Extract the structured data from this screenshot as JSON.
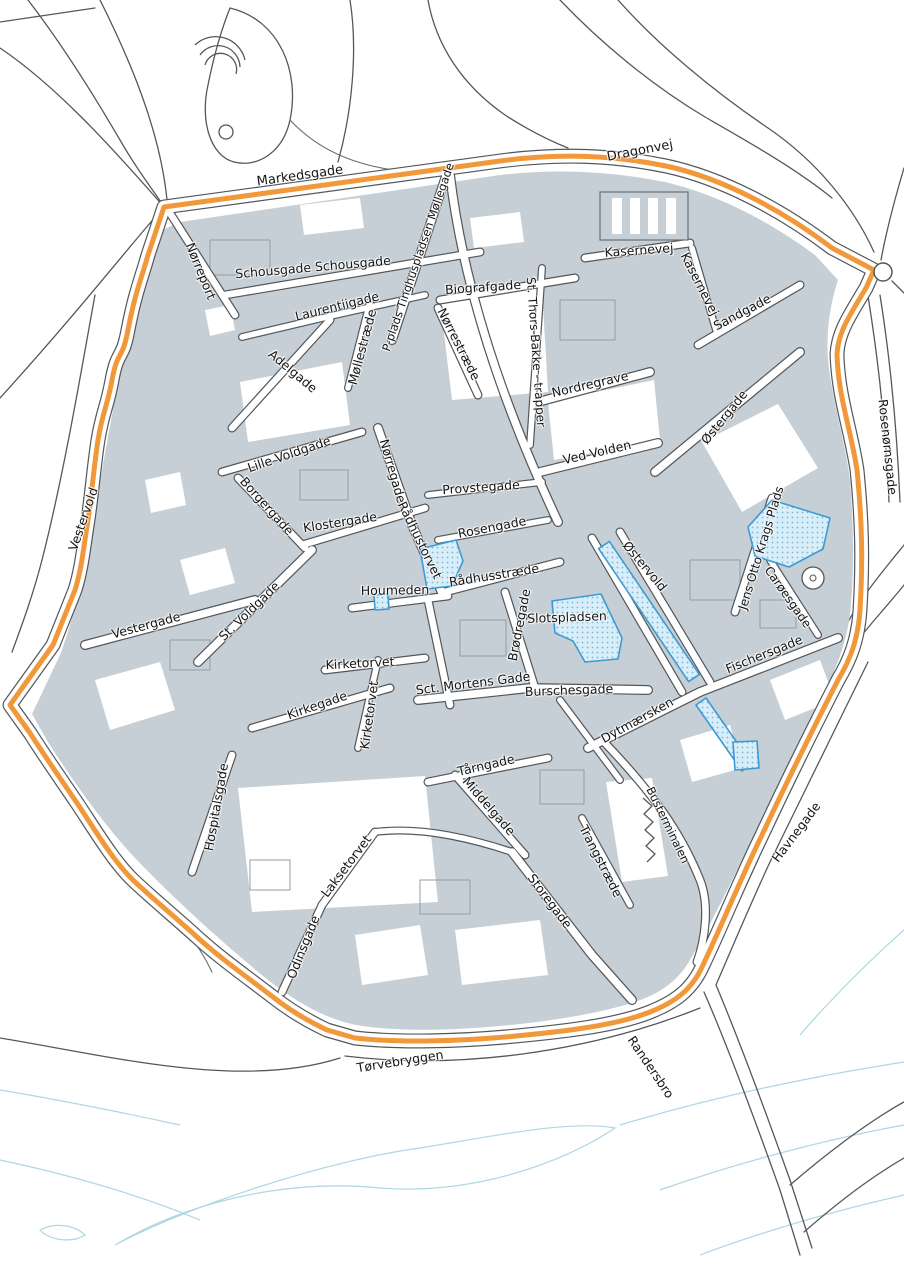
{
  "map": {
    "colors": {
      "boundary_orange": "#f0983a",
      "building_gray": "#c6cfd5",
      "road_casing": "#53565a",
      "highlight_fill": "#d8eef9",
      "highlight_border": "#3f9ad2",
      "water_blue": "#aed6e4",
      "label_color": "#151515"
    },
    "boundary_path": "M164,207 L500,161 C560,153 612,155 666,166 C722,178 782,210 832,248 L874,270 L866,288 C850,315 838,332 837,354 C838,396 851,430 857,470 C862,520 863,560 860,610 C858,640 850,660 838,680 C815,725 790,775 762,835 C740,880 722,925 703,965 C692,990 675,1002 650,1012 C615,1026 560,1032 505,1037 C460,1041 400,1043 355,1038 L327,1030 C310,1022 292,1012 273,997 C247,977 220,958 197,937 C175,917 153,899 133,880 C114,862 95,830 77,803 C60,778 42,752 30,733 L10,705 L53,645 L75,590 C82,568 84,544 88,520 C92,492 94,466 98,440 C103,410 107,408 112,380 C118,348 122,362 128,330 C135,293 141,280 148,255 Z",
    "areas": [
      {
        "name": "raadhustorvet-plaza",
        "path": "M420,549 L456,540 L463,561 L452,586 L427,589 Z"
      },
      {
        "name": "houmeden-plaza",
        "path": "M374,595 L388,594 L389,609 L375,610 Z"
      },
      {
        "name": "oestervold-promenade",
        "path": "M598.6,548.6 L609.4,541.4 L699.4,674.4 L688.6,681.6 Z"
      },
      {
        "name": "slotspladsen-plaza",
        "path": "M552,601 L601,594 L622,638 L618,659 L585,662 L573,641 L555,633 Z"
      },
      {
        "name": "dytmaersken-strip",
        "path": "M696,705 L706,698 L752,764 L742,771 Z"
      },
      {
        "name": "jens-otto-krags-plads-plaza",
        "path": "M755,556 L748,527 L772,500 L830,518 L823,549 L789,567 Z"
      },
      {
        "name": "havnegade-plaza",
        "path": "M733,742 L757,741 L759,768 L735,770 Z"
      }
    ],
    "labels": [
      {
        "text": "Markedsgade",
        "x": 300,
        "y": 176,
        "rot": -8,
        "size": 13
      },
      {
        "text": "Dragonvej",
        "x": 640,
        "y": 151,
        "rot": -11,
        "size": 13
      },
      {
        "text": "Nørreport",
        "x": 201,
        "y": 271,
        "rot": 68,
        "size": 12.5
      },
      {
        "text": "Schousgade Schousgade",
        "x": 313,
        "y": 267,
        "rot": -5,
        "size": 12.5
      },
      {
        "text": "Laurentiigade",
        "x": 337,
        "y": 306,
        "rot": -14,
        "size": 12.5
      },
      {
        "text": "P-plads Tinghuspladsen Møllegade",
        "x": 418,
        "y": 257,
        "rot": -71,
        "size": 11.5
      },
      {
        "text": "Møllestræde",
        "x": 362,
        "y": 347,
        "rot": -75,
        "size": 12.5
      },
      {
        "text": "Biografgade",
        "x": 483,
        "y": 287,
        "rot": -4,
        "size": 12.5
      },
      {
        "text": "Nørrestræde",
        "x": 459,
        "y": 344,
        "rot": 63,
        "size": 12.5
      },
      {
        "text": "St. Thors-Bakke - trapper",
        "x": 536,
        "y": 352,
        "rot": 86,
        "size": 12
      },
      {
        "text": "Kasernevej",
        "x": 639,
        "y": 250,
        "rot": -4,
        "size": 12.5
      },
      {
        "text": "Kasernevej",
        "x": 700,
        "y": 284,
        "rot": 63,
        "size": 12.5
      },
      {
        "text": "Sandgade",
        "x": 742,
        "y": 312,
        "rot": -28,
        "size": 12.5
      },
      {
        "text": "Nordregrave",
        "x": 590,
        "y": 384,
        "rot": -13,
        "size": 12.5
      },
      {
        "text": "Østergade",
        "x": 724,
        "y": 417,
        "rot": -51,
        "size": 12.5
      },
      {
        "text": "Rosenørnsgade",
        "x": 888,
        "y": 447,
        "rot": 84,
        "size": 12.5
      },
      {
        "text": "Ved Volden",
        "x": 597,
        "y": 452,
        "rot": -13,
        "size": 12.5
      },
      {
        "text": "Adelgade",
        "x": 293,
        "y": 371,
        "rot": 40,
        "size": 12.5
      },
      {
        "text": "Lille Voldgade",
        "x": 289,
        "y": 454,
        "rot": -19,
        "size": 12.5
      },
      {
        "text": "Borgergade",
        "x": 267,
        "y": 506,
        "rot": 48,
        "size": 12.5
      },
      {
        "text": "Klostergade",
        "x": 340,
        "y": 522,
        "rot": -9,
        "size": 12.5
      },
      {
        "text": "Nørregade",
        "x": 393,
        "y": 471,
        "rot": 74,
        "size": 12.5
      },
      {
        "text": "Rådhustorvet",
        "x": 420,
        "y": 540,
        "rot": 64,
        "size": 12.5
      },
      {
        "text": "Provstegade",
        "x": 481,
        "y": 487,
        "rot": -4,
        "size": 12.5
      },
      {
        "text": "Rosengade",
        "x": 492,
        "y": 527,
        "rot": -11,
        "size": 12.5
      },
      {
        "text": "Rådhusstræde",
        "x": 494,
        "y": 575,
        "rot": -9,
        "size": 12.5
      },
      {
        "text": "Houmeden",
        "x": 395,
        "y": 590,
        "rot": -1,
        "size": 12.5
      },
      {
        "text": "Brødregade",
        "x": 519,
        "y": 625,
        "rot": -79,
        "size": 12.5
      },
      {
        "text": "Slotspladsen",
        "x": 567,
        "y": 617,
        "rot": -2,
        "size": 12.5
      },
      {
        "text": "Østervold",
        "x": 645,
        "y": 566,
        "rot": 50,
        "size": 12.5
      },
      {
        "text": "Jens Otto Krags Plads",
        "x": 761,
        "y": 548,
        "rot": -73,
        "size": 12
      },
      {
        "text": "Carøesgade",
        "x": 788,
        "y": 597,
        "rot": 55,
        "size": 12
      },
      {
        "text": "Fischersgade",
        "x": 764,
        "y": 654,
        "rot": -22,
        "size": 12.5
      },
      {
        "text": "Vestervold",
        "x": 83,
        "y": 519,
        "rot": -71,
        "size": 12.5
      },
      {
        "text": "Vestergade",
        "x": 146,
        "y": 625,
        "rot": -15,
        "size": 12.5
      },
      {
        "text": "St. Voldgade",
        "x": 249,
        "y": 611,
        "rot": -44,
        "size": 12.5
      },
      {
        "text": "Kirketorvet",
        "x": 360,
        "y": 663,
        "rot": -3,
        "size": 12.5
      },
      {
        "text": "Kirkegade",
        "x": 317,
        "y": 705,
        "rot": -19,
        "size": 12.5
      },
      {
        "text": "Kirketorvet",
        "x": 369,
        "y": 715,
        "rot": -82,
        "size": 12.5
      },
      {
        "text": "Sct. Mortens Gade",
        "x": 473,
        "y": 683,
        "rot": -7,
        "size": 12.5
      },
      {
        "text": "Burschesgade",
        "x": 569,
        "y": 690,
        "rot": -2,
        "size": 12.5
      },
      {
        "text": "Dytmærsken",
        "x": 637,
        "y": 720,
        "rot": -29,
        "size": 12.5
      },
      {
        "text": "Tårngade",
        "x": 486,
        "y": 765,
        "rot": -13,
        "size": 12.5
      },
      {
        "text": "Middelgade",
        "x": 489,
        "y": 806,
        "rot": 49,
        "size": 12.5
      },
      {
        "text": "Trangstræde",
        "x": 601,
        "y": 861,
        "rot": 63,
        "size": 12.5
      },
      {
        "text": "Busterminalen",
        "x": 668,
        "y": 825,
        "rot": 64,
        "size": 11.5
      },
      {
        "text": "Storegade",
        "x": 550,
        "y": 901,
        "rot": 53,
        "size": 12.5
      },
      {
        "text": "Laksetorvet",
        "x": 346,
        "y": 866,
        "rot": -53,
        "size": 12.5
      },
      {
        "text": "Hospitalsgade",
        "x": 216,
        "y": 807,
        "rot": -80,
        "size": 12.5
      },
      {
        "text": "Odinsgade",
        "x": 303,
        "y": 947,
        "rot": -68,
        "size": 12.5
      },
      {
        "text": "Havnegade",
        "x": 796,
        "y": 832,
        "rot": -53,
        "size": 12.5
      },
      {
        "text": "Tørvebryggen",
        "x": 400,
        "y": 1061,
        "rot": -9,
        "size": 12.5
      },
      {
        "text": "Randersbro",
        "x": 651,
        "y": 1067,
        "rot": 56,
        "size": 12.5
      }
    ]
  }
}
